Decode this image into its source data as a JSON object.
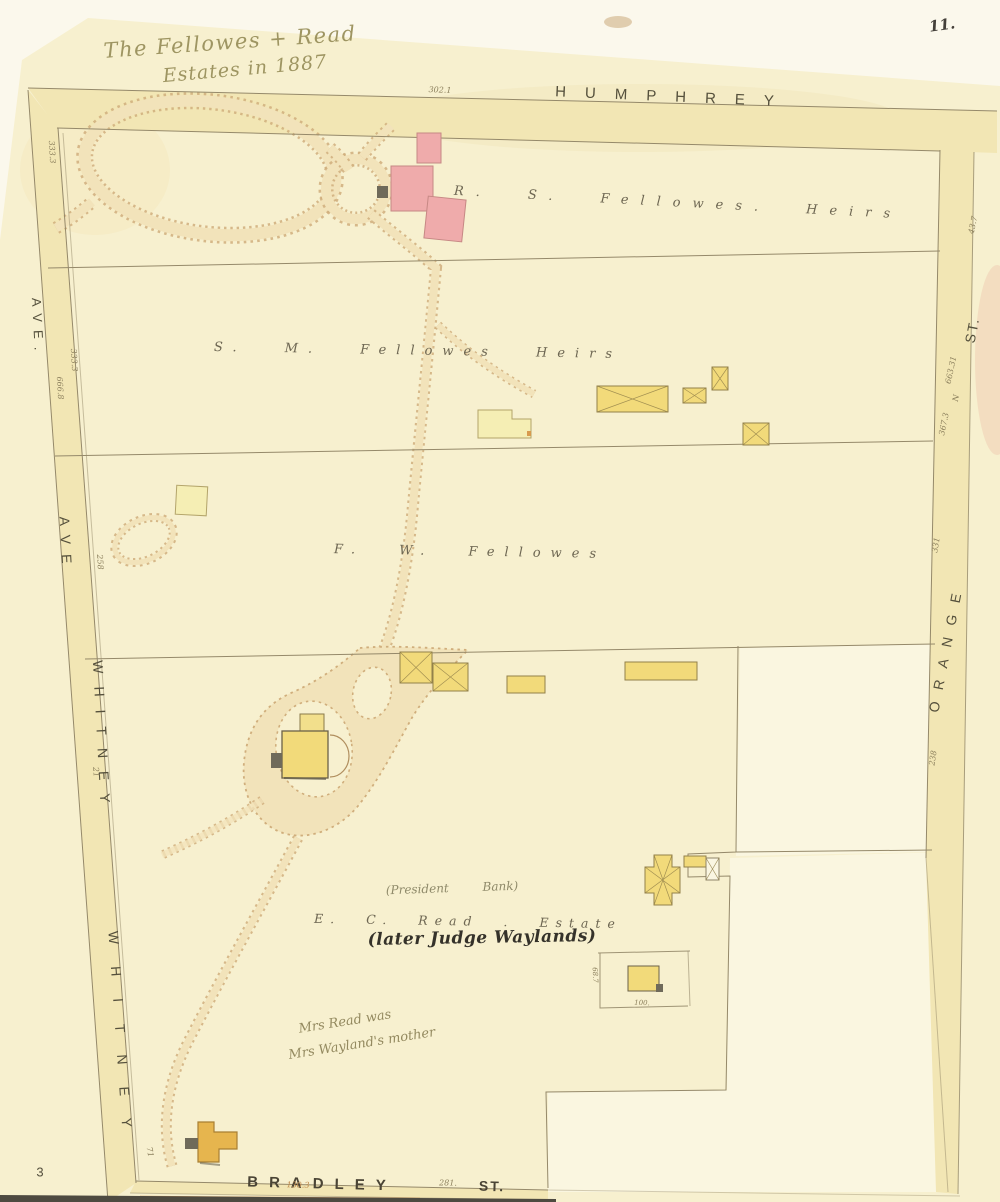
{
  "colors": {
    "paper": "#f7f0cf",
    "band": "#f2e6b4",
    "line": "#95896a",
    "building-yellow": "#f2da7a",
    "building-pale": "#f5eeb4",
    "building-pink": "#efabab",
    "building-orange": "#e6b54e",
    "path-tan": "#f2e3ba",
    "path-edge": "#d0ae7c"
  },
  "page": {
    "number": "11.",
    "sheet": "3"
  },
  "title": {
    "line1": "The Fellowes + Read",
    "line2": "Estates in 1887"
  },
  "streets": {
    "humphrey": "HUMPHREY",
    "ave_top": "AVE.",
    "ave": "AVE",
    "whitney_upper": "WHITNEY",
    "whitney_lower": "WHITNEY",
    "st_right": "ST.",
    "orange": "ORANGE",
    "bradley": "BRADLEY",
    "st_bottom": "ST."
  },
  "parcels": {
    "rs_fellowes": "R. S. Fellowes. Heirs",
    "sm_fellowes": "S. M. Fellowes Heirs",
    "fw_fellowes": "F. W. Fellowes",
    "ec_read": "E. C. Read . Estate"
  },
  "annotations": {
    "president_bank": "(President Bank)",
    "later_judge": "(later Judge Waylands)",
    "mrs_read_line1": "Mrs Read was",
    "mrs_read_line2": "Mrs Wayland's mother"
  },
  "dimensions": {
    "humphrey_3021": "302.1",
    "whitney_3333_top": "333.3",
    "whitney_3333": "333.3",
    "whitney_6668": "666.8",
    "whitney_258": "258",
    "whitney_21": "21",
    "whitney_71": "71",
    "orange_437": "43.7",
    "orange_66331": "663.31",
    "orange_n": "N",
    "orange_3673": "367.3",
    "orange_331": "331",
    "orange_238": "238",
    "lot_687": "68.7",
    "lot_100": "100.",
    "bradley_1303": "130.3",
    "bradley_281": "281."
  }
}
